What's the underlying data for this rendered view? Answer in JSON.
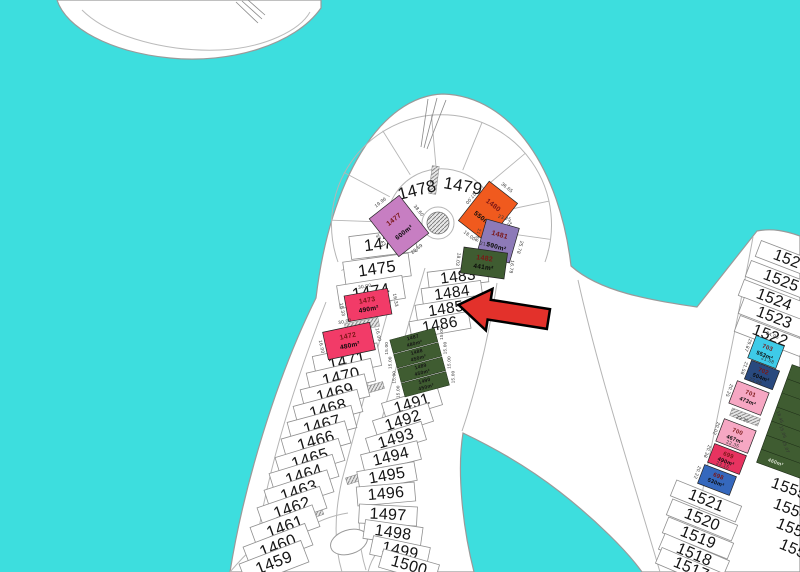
{
  "map_title": "palm-frond-plot-map",
  "colors": {
    "water": "#3DDEDE",
    "land": "#FFFFFF",
    "arrow": "#E3312B",
    "orchid": "#C77EC2",
    "orange": "#F05A1E",
    "purple": "#8D7AB8",
    "dark_green": "#3F5C31",
    "pink_red": "#F23B68",
    "cyan_plot": "#3ECBE8",
    "navy": "#29497E",
    "light_pink": "#F6A7C3",
    "crimson": "#E73360",
    "steel_blue": "#3568BD"
  },
  "plots": {
    "arc_labels": [
      "1478",
      "1479"
    ],
    "left_column": [
      "1476",
      "1475",
      "1474",
      "1471",
      "1470",
      "1469",
      "1468",
      "1467",
      "1466",
      "1465",
      "1464",
      "1463",
      "1462",
      "1461",
      "1460",
      "1459"
    ],
    "middle_column_upper": [
      "1483",
      "1484",
      "1485",
      "1486"
    ],
    "middle_column_lower": [
      "1491",
      "1492",
      "1493",
      "1494",
      "1495",
      "1496",
      "1497",
      "1498",
      "1499",
      "1500"
    ],
    "colored": [
      {
        "id": "1477",
        "area": "600m²",
        "color_key": "orchid",
        "dims": [
          "39.43",
          "19.96",
          "38.60",
          "29.69"
        ]
      },
      {
        "id": "1480",
        "area": "550m²",
        "color_key": "orange",
        "dims": [
          "27.00",
          "36.65",
          "20.19",
          "18.00"
        ]
      },
      {
        "id": "1481",
        "area": "500m²",
        "color_key": "purple",
        "dims": [
          "21.58",
          "23.25",
          "25.78"
        ]
      },
      {
        "id": "1482",
        "area": "441m²",
        "color_key": "dark_green",
        "dims": [
          "18.03",
          "21.98",
          "16.78"
        ]
      },
      {
        "id": "1473",
        "area": "490m²",
        "color_key": "pink_red",
        "dims": [
          "16.33",
          "30.00",
          "16.33"
        ]
      },
      {
        "id": "1472",
        "area": "480m²",
        "color_key": "pink_red",
        "dims": [
          "16.00",
          "30.00",
          "16.00"
        ]
      }
    ],
    "green_row_plots": [
      {
        "id": "1487",
        "area": "480m²"
      },
      {
        "id": "1488",
        "area": "450m²"
      },
      {
        "id": "1489",
        "area": "450m²"
      },
      {
        "id": "1490",
        "area": "450m²"
      }
    ],
    "green_row_dims": [
      "15.00",
      "15.00",
      "15.00",
      "15.00",
      "15.00",
      "15.00",
      "15.00",
      "15.00"
    ],
    "right_column": {
      "upper": [
        "1526",
        "1525",
        "1524",
        "1523",
        "1522"
      ],
      "colored": [
        {
          "id": "703",
          "area": "553m²",
          "color_key": "cyan_plot",
          "dims": [
            "29.87",
            "24.95"
          ]
        },
        {
          "id": "702",
          "area": "504m²",
          "color_key": "navy",
          "dims": [
            "21.58",
            "21.58"
          ]
        },
        {
          "id": "701",
          "area": "473m²",
          "color_key": "light_pink",
          "dims": [
            "20.25",
            "23.98"
          ]
        },
        {
          "id": "700",
          "area": "467m²",
          "color_key": "light_pink",
          "dims": [
            "20.02",
            "22.35"
          ]
        },
        {
          "id": "699",
          "area": "490m²",
          "color_key": "crimson",
          "dims": [
            "20.38",
            "22.35"
          ]
        },
        {
          "id": "698",
          "area": "530m²",
          "color_key": "steel_blue",
          "dims": [
            "20.22",
            "23.15"
          ]
        }
      ],
      "lower": [
        "1521",
        "1520",
        "1519",
        "1518",
        "1517"
      ]
    },
    "far_right": {
      "labels": [
        "1555",
        "1554",
        "1553",
        "1552"
      ],
      "green_area_label": "460m²",
      "dims": [
        "18.45",
        "15.06",
        "15.07"
      ]
    }
  }
}
